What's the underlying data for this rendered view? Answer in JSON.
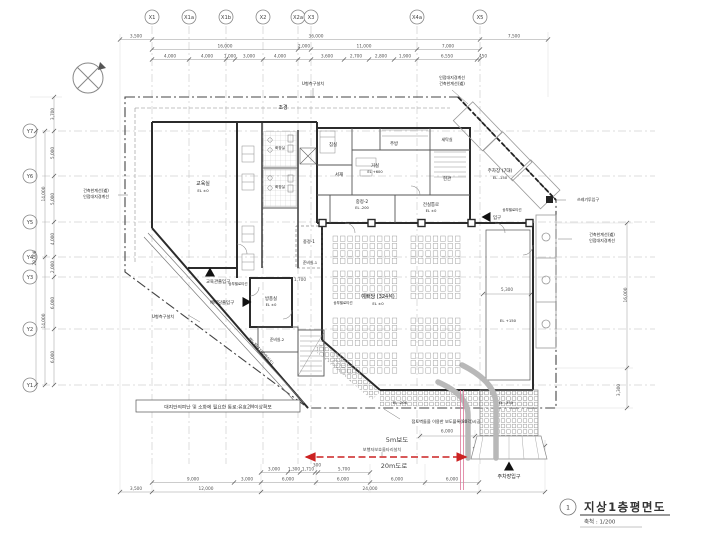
{
  "title_block": {
    "number": "1",
    "title": "지상1층평면도",
    "scale_label": "축척 : 1/200"
  },
  "note": "대지안의피난 및 소화에 필요한 통로:유효2M이상확보",
  "roads": {
    "sidewalk": "5m보도",
    "road": "20m도로"
  },
  "fence_label": "보행자보호울타리설치",
  "colors": {
    "wall": "#2b2b2b",
    "dim": "#555555",
    "grid": "#bbbbbb",
    "red_arrow": "#cc2222",
    "road_curb": "#b8b8b8",
    "pink_line": "#dd7799"
  },
  "grid": {
    "x": [
      {
        "label": "X1",
        "pos": 152
      },
      {
        "label": "X1a",
        "pos": 189
      },
      {
        "label": "X1b",
        "pos": 226
      },
      {
        "label": "X2",
        "pos": 263
      },
      {
        "label": "X2a",
        "pos": 298
      },
      {
        "label": "X3",
        "pos": 311
      },
      {
        "label": "X4a",
        "pos": 417
      },
      {
        "label": "X5",
        "pos": 480
      }
    ],
    "y": [
      {
        "label": "Y7",
        "pos": 131
      },
      {
        "label": "Y6",
        "pos": 176
      },
      {
        "label": "Y5",
        "pos": 222
      },
      {
        "label": "Y4",
        "pos": 257
      },
      {
        "label": "Y3",
        "pos": 277
      },
      {
        "label": "Y2",
        "pos": 329
      },
      {
        "label": "Y1",
        "pos": 385
      }
    ]
  },
  "dims": [
    {
      "t": "3,500",
      "x": 136,
      "y": 37.5
    },
    {
      "t": "36,000",
      "x": 316,
      "y": 37.5
    },
    {
      "t": "7,500",
      "x": 514,
      "y": 37.5
    },
    {
      "t": "16,000",
      "x": 225,
      "y": 47.5
    },
    {
      "t": "2,000",
      "x": 304,
      "y": 47.5
    },
    {
      "t": "11,000",
      "x": 364,
      "y": 47.5
    },
    {
      "t": "7,000",
      "x": 448,
      "y": 47.5
    },
    {
      "t": "4,000",
      "x": 170,
      "y": 57.5
    },
    {
      "t": "4,000",
      "x": 207,
      "y": 57.5
    },
    {
      "t": "1,000",
      "x": 230,
      "y": 57.5
    },
    {
      "t": "3,000",
      "x": 249,
      "y": 57.5
    },
    {
      "t": "4,000",
      "x": 280,
      "y": 57.5
    },
    {
      "t": "3,600",
      "x": 327,
      "y": 57.5
    },
    {
      "t": "2,700",
      "x": 356,
      "y": 57.5
    },
    {
      "t": "2,800",
      "x": 381,
      "y": 57.5
    },
    {
      "t": "1,900",
      "x": 405,
      "y": 57.5
    },
    {
      "t": "6,550",
      "x": 447,
      "y": 57.5
    },
    {
      "t": "450",
      "x": 483,
      "y": 57.5
    },
    {
      "t": "3,700",
      "x": 54,
      "y": 114,
      "r": -90
    },
    {
      "t": "5,000",
      "x": 54,
      "y": 153,
      "r": -90
    },
    {
      "t": "5,000",
      "x": 54,
      "y": 199,
      "r": -90
    },
    {
      "t": "4,000",
      "x": 54,
      "y": 239,
      "r": -90
    },
    {
      "t": "2,000",
      "x": 54,
      "y": 267,
      "r": -90
    },
    {
      "t": "6,000",
      "x": 54,
      "y": 303,
      "r": -90
    },
    {
      "t": "6,000",
      "x": 54,
      "y": 357,
      "r": -90
    },
    {
      "t": "14,000",
      "x": 45,
      "y": 194,
      "r": -90
    },
    {
      "t": "14,000",
      "x": 45,
      "y": 321,
      "r": -90
    },
    {
      "t": "28,000",
      "x": 36,
      "y": 258,
      "r": -90
    },
    {
      "t": "3,000",
      "x": 274,
      "y": 470.5
    },
    {
      "t": "1,300",
      "x": 294,
      "y": 470.5
    },
    {
      "t": "1,710",
      "x": 308,
      "y": 470.5
    },
    {
      "t": "300",
      "x": 317,
      "y": 466.5
    },
    {
      "t": "5,700",
      "x": 344,
      "y": 470.5
    },
    {
      "t": "9,000",
      "x": 193,
      "y": 480.5
    },
    {
      "t": "3,000",
      "x": 247,
      "y": 480.5
    },
    {
      "t": "6,000",
      "x": 288,
      "y": 480.5
    },
    {
      "t": "6,000",
      "x": 343,
      "y": 480.5
    },
    {
      "t": "6,000",
      "x": 397,
      "y": 480.5
    },
    {
      "t": "6,000",
      "x": 452,
      "y": 480.5
    },
    {
      "t": "3,500",
      "x": 136,
      "y": 490
    },
    {
      "t": "12,000",
      "x": 206,
      "y": 490
    },
    {
      "t": "24,000",
      "x": 370,
      "y": 490
    },
    {
      "t": "6,000",
      "x": 447,
      "y": 432.5
    },
    {
      "t": "7,500",
      "x": 510,
      "y": 442.5
    },
    {
      "t": "5,300",
      "x": 507,
      "y": 291
    },
    {
      "t": "1,700",
      "x": 300,
      "y": 281
    },
    {
      "t": "16,000",
      "x": 627,
      "y": 295,
      "r": -90
    },
    {
      "t": "3,300",
      "x": 620,
      "y": 390,
      "r": -90
    }
  ],
  "ticks": [
    {
      "y": 39.5,
      "xs": [
        120,
        152,
        480,
        548
      ]
    },
    {
      "y": 49.5,
      "xs": [
        152,
        298,
        311,
        417,
        480
      ]
    },
    {
      "y": 59.5,
      "xs": [
        152,
        189,
        226,
        235,
        263,
        298,
        311,
        344,
        369,
        394,
        417,
        477,
        480
      ]
    },
    {
      "x": 36,
      "ys": [
        131,
        385
      ]
    },
    {
      "x": 45,
      "ys": [
        131,
        257,
        385
      ]
    },
    {
      "x": 54,
      "ys": [
        97,
        131,
        176,
        222,
        257,
        277,
        329,
        385
      ]
    },
    {
      "y": 472.5,
      "xs": [
        261,
        288,
        300,
        315,
        318,
        370
      ]
    },
    {
      "y": 482.5,
      "xs": [
        152,
        234,
        261,
        316,
        370,
        425,
        479
      ]
    },
    {
      "y": 492,
      "xs": [
        120,
        152,
        261,
        479,
        545
      ]
    },
    {
      "y": 436,
      "xs": [
        420,
        475
      ]
    },
    {
      "y": 446,
      "xs": [
        475,
        545
      ]
    },
    {
      "y": 294,
      "xs": [
        483,
        531
      ]
    },
    {
      "x": 627,
      "ys": [
        223,
        368,
        408
      ]
    }
  ],
  "labels": [
    {
      "t": "교육실",
      "x": 203,
      "y": 185,
      "s": 5
    },
    {
      "t": "EL ±0",
      "x": 203,
      "y": 192,
      "s": 3.8
    },
    {
      "t": "화장실",
      "x": 280,
      "y": 149,
      "s": 3.6
    },
    {
      "t": "화장실",
      "x": 280,
      "y": 188,
      "s": 3.6
    },
    {
      "t": "침실",
      "x": 333,
      "y": 146,
      "s": 4.4
    },
    {
      "t": "주방",
      "x": 394,
      "y": 145,
      "s": 4.4
    },
    {
      "t": "서재",
      "x": 339,
      "y": 176,
      "s": 4.4
    },
    {
      "t": "거실",
      "x": 375,
      "y": 167,
      "s": 4.4
    },
    {
      "t": "EL +600",
      "x": 375,
      "y": 173,
      "s": 3.6
    },
    {
      "t": "세탁실",
      "x": 447,
      "y": 141,
      "s": 4
    },
    {
      "t": "현관",
      "x": 447,
      "y": 180,
      "s": 4.4
    },
    {
      "t": "중정-2",
      "x": 362,
      "y": 203,
      "s": 4.4
    },
    {
      "t": "EL -200",
      "x": 362,
      "y": 209,
      "s": 3.6
    },
    {
      "t": "전실통로",
      "x": 431,
      "y": 206,
      "s": 4.4
    },
    {
      "t": "EL ±0",
      "x": 431,
      "y": 212,
      "s": 3.6
    },
    {
      "t": "중정-1",
      "x": 309,
      "y": 243,
      "s": 4.2
    },
    {
      "t": "방풍실",
      "x": 271,
      "y": 300,
      "s": 4.4
    },
    {
      "t": "EL ±0",
      "x": 271,
      "y": 306,
      "s": 3.6
    },
    {
      "t": "준비실-1",
      "x": 310,
      "y": 264,
      "s": 3.8
    },
    {
      "t": "준비실-2",
      "x": 277,
      "y": 341,
      "s": 3.8
    },
    {
      "t": "예배당 (324석)",
      "x": 378,
      "y": 298,
      "s": 5
    },
    {
      "t": "EL ±0",
      "x": 378,
      "y": 305,
      "s": 3.8
    },
    {
      "t": "주차장 (7대)",
      "x": 500,
      "y": 172,
      "s": 4.6
    },
    {
      "t": "EL -150",
      "x": 500,
      "y": 179,
      "s": 3.8
    },
    {
      "t": "EL -200",
      "x": 400,
      "y": 404,
      "s": 3.8
    },
    {
      "t": "EL -350",
      "x": 506,
      "y": 404,
      "s": 3.8
    },
    {
      "t": "EL +150",
      "x": 508,
      "y": 322,
      "s": 3.8
    },
    {
      "t": "교육관출입구",
      "x": 218,
      "y": 283,
      "s": 4.4
    },
    {
      "t": "예배당출입구",
      "x": 222,
      "y": 304,
      "s": 4.4
    },
    {
      "t": "입구",
      "x": 497,
      "y": 219,
      "s": 4.4
    },
    {
      "t": "상부필로티선",
      "x": 512,
      "y": 211,
      "s": 3.5
    },
    {
      "t": "상부필로티선",
      "x": 343,
      "y": 304,
      "s": 3.5
    },
    {
      "t": "상부필로티선",
      "x": 238,
      "y": 285,
      "s": 3.5
    },
    {
      "t": "주차장입구",
      "x": 509,
      "y": 478,
      "s": 5
    },
    {
      "t": "조경",
      "x": 283,
      "y": 109,
      "s": 5
    },
    {
      "t": "U형측구설치",
      "x": 313,
      "y": 85,
      "s": 4.2
    },
    {
      "t": "U형측구설치",
      "x": 163,
      "y": 318,
      "s": 4.2
    },
    {
      "t": "인접대지경계선",
      "x": 452,
      "y": 79,
      "s": 4
    },
    {
      "t": "건축한계선(道)",
      "x": 452,
      "y": 85,
      "s": 4
    },
    {
      "t": "건축한계선(道)",
      "x": 96,
      "y": 192,
      "s": 4
    },
    {
      "t": "인접대지경계선",
      "x": 96,
      "y": 198,
      "s": 4
    },
    {
      "t": "쓰레기투입구",
      "x": 588,
      "y": 201,
      "s": 4
    },
    {
      "t": "건축한계선(道)",
      "x": 602,
      "y": 236,
      "s": 4
    },
    {
      "t": "인접대지경계선",
      "x": 602,
      "y": 242,
      "s": 4
    },
    {
      "t": "점토벽돌을 이용한 보도블록(80각)시공",
      "x": 446,
      "y": 423,
      "s": 4.2
    },
    {
      "t": "캐노피(1100와이드)",
      "x": 260,
      "y": 352,
      "s": 4,
      "r": 48
    }
  ],
  "triangles": [
    {
      "x": 210,
      "y": 272,
      "dir": "up"
    },
    {
      "x": 247,
      "y": 302,
      "dir": "right"
    },
    {
      "x": 486,
      "y": 217,
      "dir": "left"
    },
    {
      "x": 509,
      "y": 466,
      "dir": "up"
    }
  ],
  "seating": {
    "blocks": [
      {
        "x0": 333,
        "cols": 9,
        "pitch": 7.4
      },
      {
        "x0": 411,
        "cols": 7,
        "pitch": 7.4
      }
    ],
    "groups": [
      {
        "y0": 236,
        "rows": 4
      },
      {
        "y0": 271,
        "rows": 4
      },
      {
        "y0": 318,
        "rows": 4
      },
      {
        "y0": 353,
        "rows": 3
      }
    ],
    "seat_w": 4.6,
    "seat_h": 5.4,
    "row_pitch": 7.4
  }
}
